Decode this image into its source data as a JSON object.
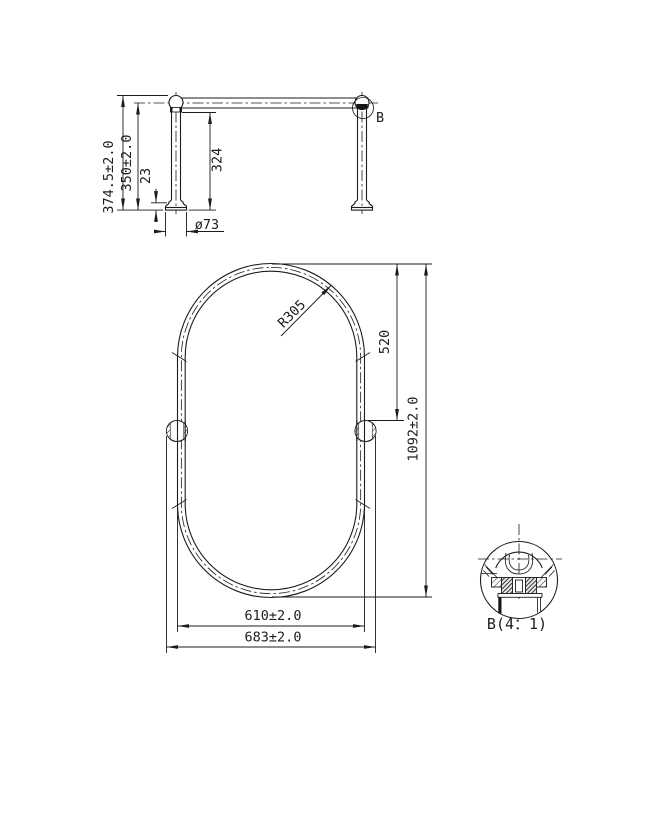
{
  "drawing": {
    "background_color": "#ffffff",
    "line_color": "#1c1c1c",
    "side_view": {
      "dim_overall_height": "374.5±2.0",
      "dim_height_to_rail_center": "350±2.0",
      "dim_base_height": "23",
      "dim_post_height": "324",
      "dim_base_diameter": "ø73",
      "detail_callout": "B"
    },
    "front_view": {
      "dim_top_radius": "R305",
      "dim_top_to_fitting": "520",
      "dim_overall_height": "1092±2.0",
      "dim_tube_width": "610±2.0",
      "dim_outer_width": "683±2.0"
    },
    "detail_view": {
      "label": "B(4：1)"
    }
  }
}
